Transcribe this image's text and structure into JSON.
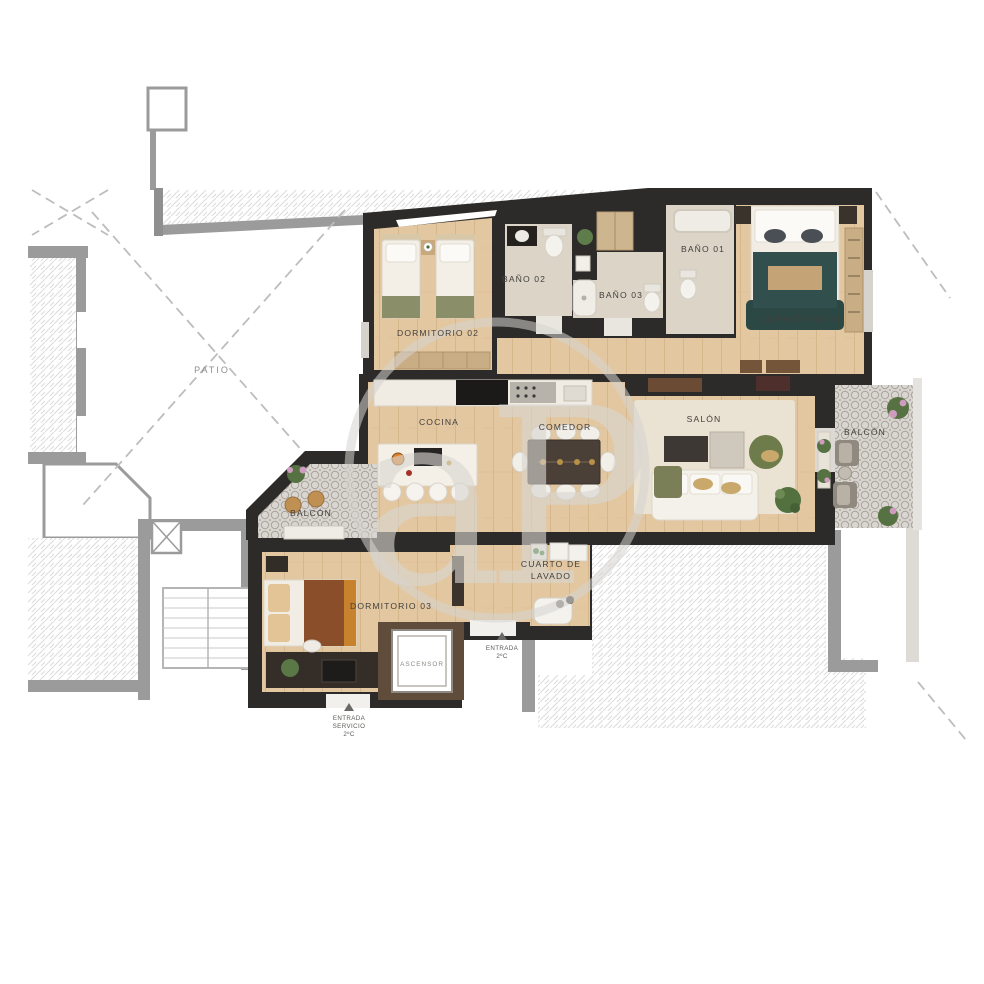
{
  "title": "Plano de planta - vivienda 2ºC",
  "watermark": {
    "text": "aP"
  },
  "labels": {
    "patio": "PATIO",
    "dormitorio01": "DORMITORIO 01",
    "dormitorio02": "DORMITORIO 02",
    "dormitorio03": "DORMITORIO 03",
    "bano01": "BAÑO 01",
    "bano02": "BAÑO 02",
    "bano03": "BAÑO 03",
    "cocina": "COCINA",
    "comedor": "COMEDOR",
    "salon": "SALÓN",
    "balconLeft": "BALCÓN",
    "balconRight": "BALCÓN",
    "lavado1": "CUARTO DE",
    "lavado2": "LAVADO",
    "ascensor": "ASCENSOR",
    "entrada1": "ENTRADA",
    "entrada2": "2ºC",
    "servicio1": "ENTRADA",
    "servicio2": "SERVICIO",
    "servicio3": "2ºC"
  },
  "colors": {
    "wall_dark": "#2d2b29",
    "wood_floor": "#e3c7a0",
    "bath_floor": "#dbd4c7",
    "tile_floor": "#d9d5d0",
    "neighbor_gray": "#9b9b9b",
    "hatch_line": "#d9d9d9",
    "bed_teal": "#31504d",
    "blanket_sienna": "#8a4f2a",
    "plant_green": "#567243",
    "flower_pink": "#cf9cc0",
    "marble_white": "#f2efe8"
  }
}
